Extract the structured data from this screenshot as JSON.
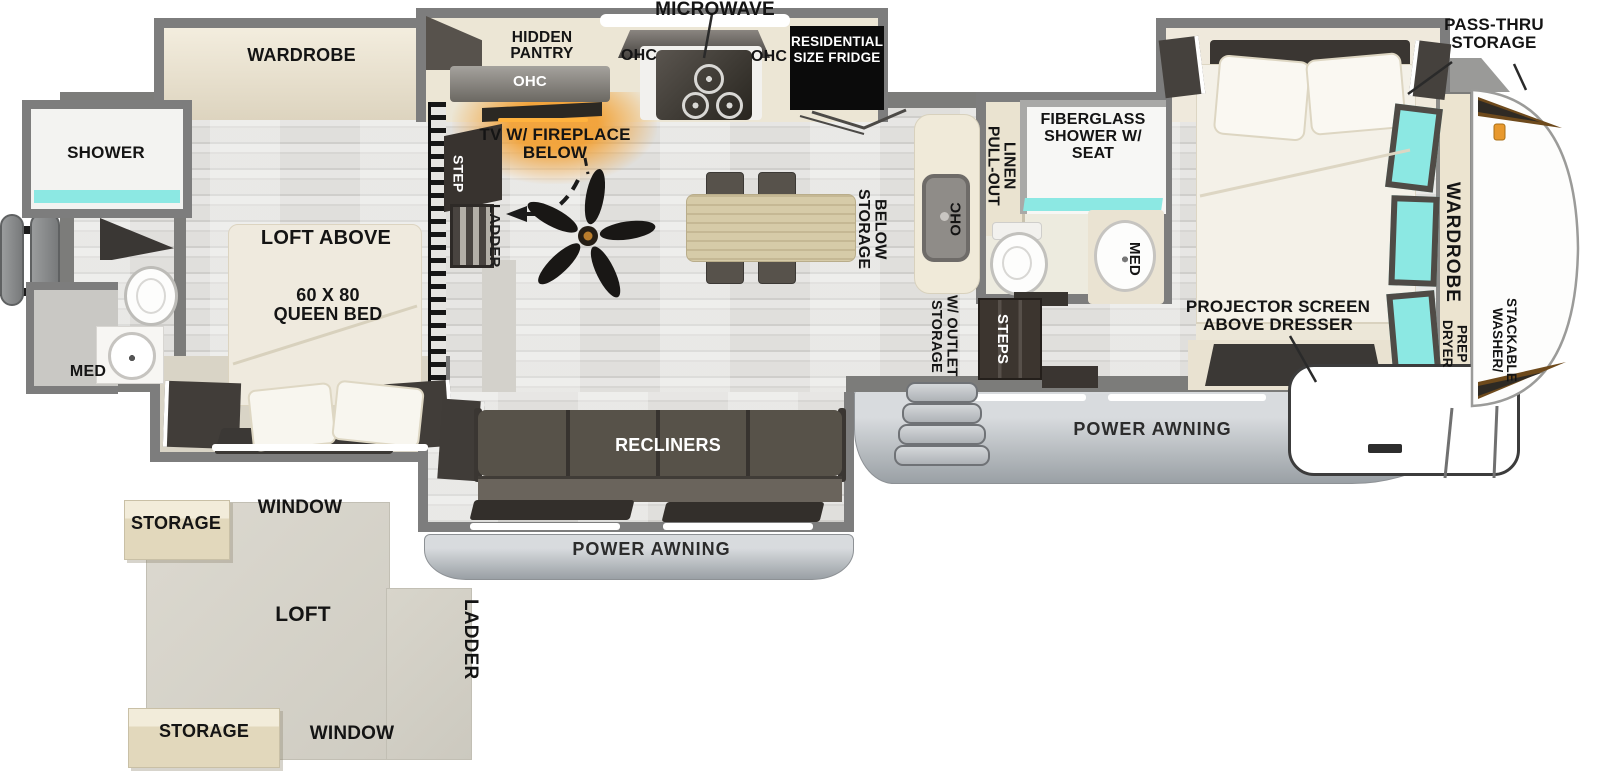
{
  "labels": {
    "exterior": {
      "pass_thru_storage": "PASS-THRU STORAGE",
      "power_awning_main": "POWER AWNING",
      "power_awning_living": "POWER AWNING",
      "stackable_washer": "STACKABLE WASHER/",
      "dryer_prep": "DRYER PREP"
    },
    "kitchen": {
      "microwave": "MICROWAVE",
      "hidden_pantry": "HIDDEN PANTRY",
      "ohc_pantry": "OHC",
      "ohc_left": "OHC",
      "ohc_right": "OHC",
      "fridge": "RESIDENTIAL SIZE FRIDGE",
      "island_ohc": "OHC",
      "storage_below": "STORAGE BELOW",
      "storage_outlet": "STORAGE W/ OUTLET"
    },
    "living": {
      "tv_fireplace": "TV W/ FIREPLACE BELOW",
      "recliners": "RECLINERS",
      "step": "STEP",
      "ladder": "LADDER",
      "steps": "STEPS"
    },
    "rear_suite": {
      "wardrobe": "WARDROBE",
      "shower": "SHOWER",
      "med": "MED",
      "loft_above": "LOFT ABOVE",
      "queen_bed": "60 X 80 QUEEN BED"
    },
    "mid_bath": {
      "pull_out_linen": "PULL-OUT LINEN",
      "fiberglass_shower": "FIBERGLASS SHOWER W/ SEAT",
      "med": "MED"
    },
    "front_suite": {
      "projector_screen": "PROJECTOR SCREEN ABOVE DRESSER",
      "wardrobe": "WARDROBE"
    },
    "loft_inset": {
      "storage_top": "STORAGE",
      "window_top": "WINDOW",
      "loft": "LOFT",
      "ladder": "LADDER",
      "storage_bottom": "STORAGE",
      "window_bottom": "WINDOW"
    }
  },
  "colors": {
    "wall_gray": "#7c7c7a",
    "cream_furniture": "#ece5d3",
    "dark_furniture": "#3d3936",
    "window_teal": "#8ce8e3",
    "fireplace_orange": "#f2a135",
    "awning_gray": "#c3c7cb",
    "label_black": "#141414"
  }
}
